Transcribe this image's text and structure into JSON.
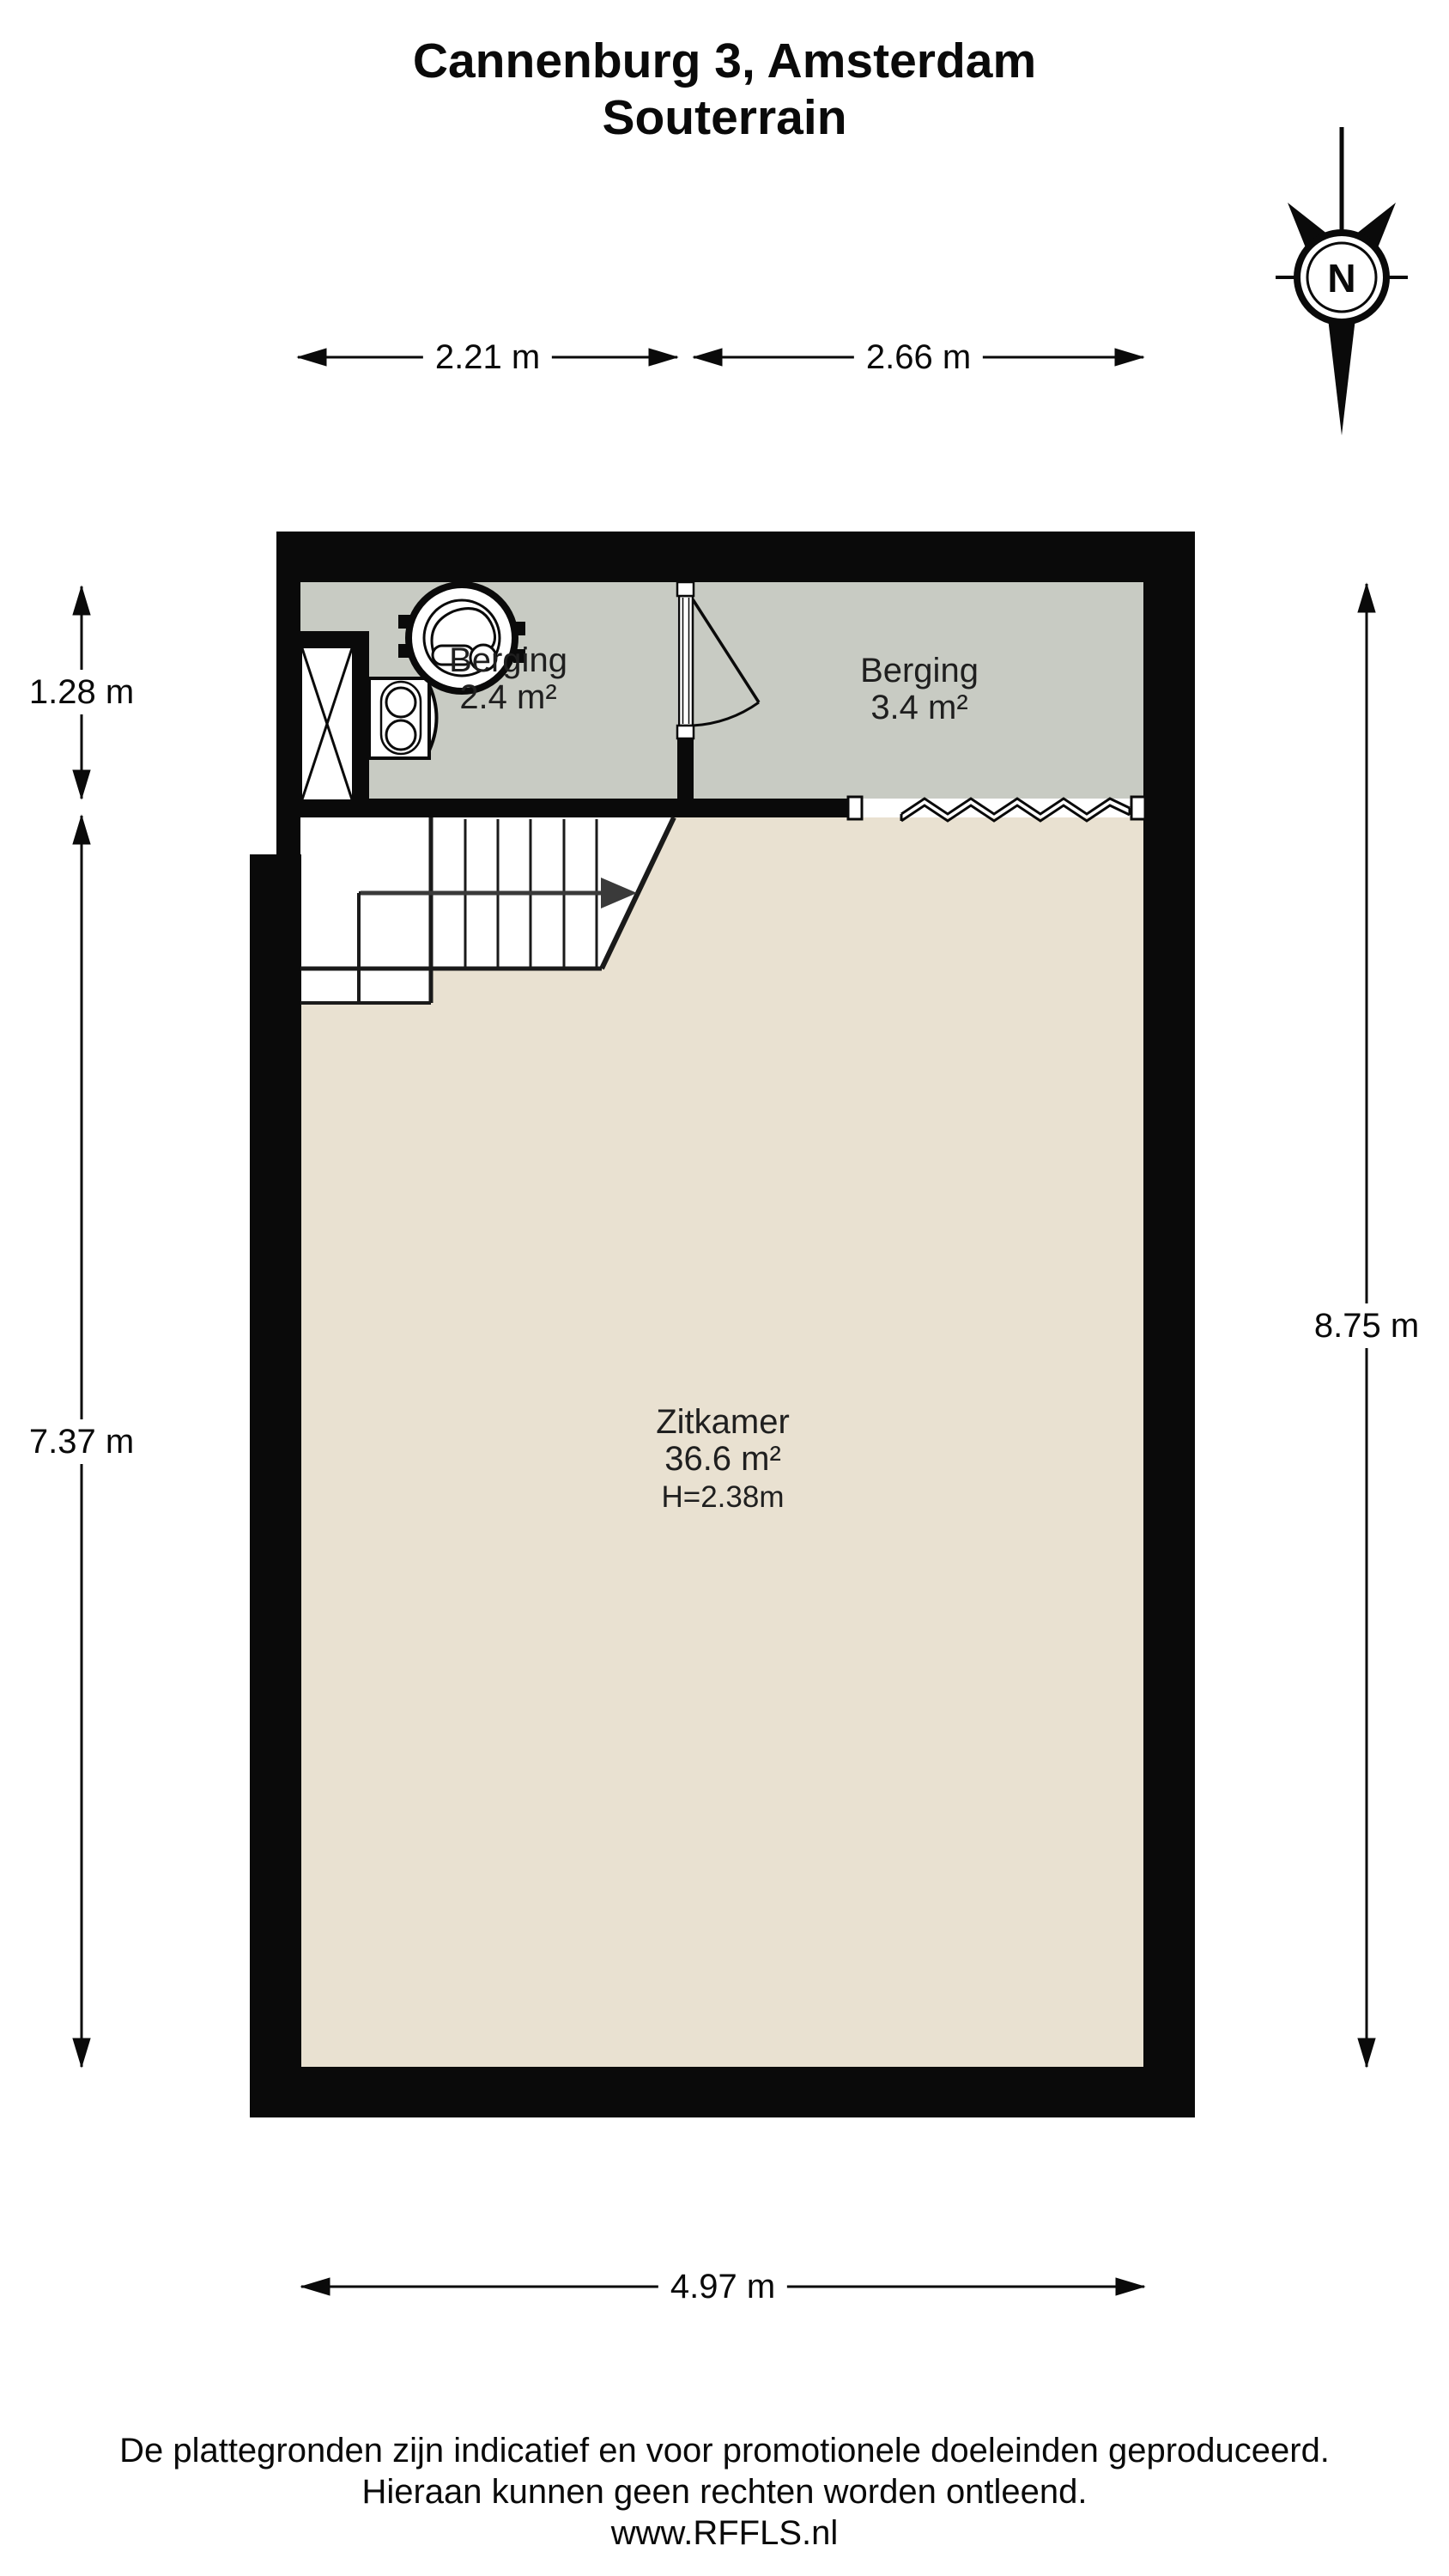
{
  "title": {
    "line1": "Cannenburg 3, Amsterdam",
    "line2": "Souterrain"
  },
  "compass": {
    "label": "N"
  },
  "dimensions": {
    "top_left": "2.21 m",
    "top_right": "2.66 m",
    "left_upper": "1.28 m",
    "left_lower": "7.37 m",
    "right_side": "8.75 m",
    "bottom": "4.97 m"
  },
  "rooms": [
    {
      "name": "Berging",
      "area": "2.4 m²"
    },
    {
      "name": "Berging",
      "area": "3.4 m²"
    },
    {
      "name": "Zitkamer",
      "area": "36.6 m²",
      "ceiling_height": "H=2.38m"
    }
  ],
  "icons": {
    "compass": "north-compass-icon",
    "boiler": "boiler-unit-icon",
    "washer": "washing-machine-icon",
    "shaft": "shaft-cross-icon",
    "stairs": "staircase-direction-arrow",
    "window": "zigzag-opening-icon"
  },
  "footer": {
    "line1": "De plattegronden zijn indicatief en voor promotionele doeleinden geproduceerd.",
    "line2": "Hieraan kunnen geen rechten worden ontleend.",
    "line3": "www.RFFLS.nl"
  },
  "colors": {
    "wall": "#0a0a0a",
    "storage_floor": "#c8cbc3",
    "living_floor": "#e9e1d1",
    "background": "#ffffff",
    "text": "#1a1a1a",
    "stair_arrow": "#3a3a3a"
  }
}
